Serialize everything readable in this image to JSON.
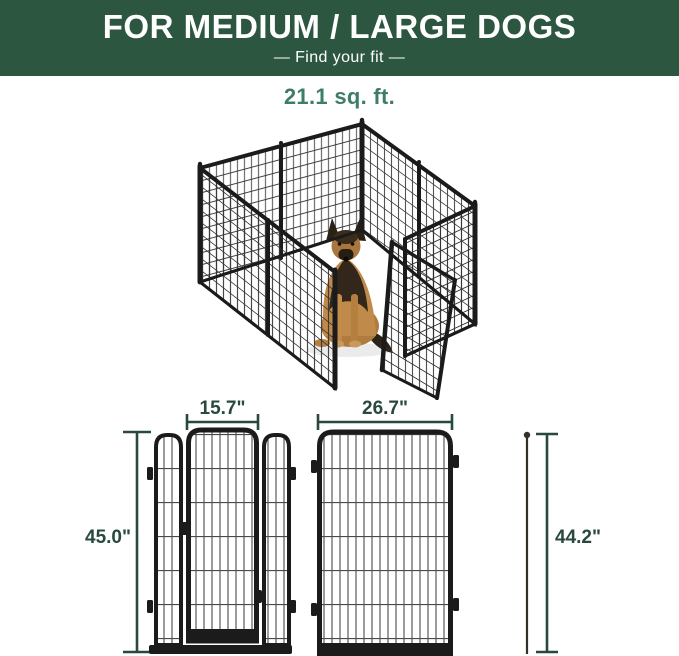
{
  "colors": {
    "banner_bg": "#2C5640",
    "banner_text": "#FFFFFF",
    "accent_green": "#3E7E66",
    "dim_line": "#29493D",
    "frame_black": "#1B1B1B",
    "wire_gray": "#4A4A4A",
    "dog_tan": "#C08A4A",
    "dog_dark": "#32271A"
  },
  "banner": {
    "title": "FOR MEDIUM / LARGE DOGS",
    "subtitle": "—  Find your fit  —"
  },
  "area": {
    "label": "21.1 sq. ft."
  },
  "product": {
    "image_alt": "8-panel metal dog playpen with open door and german shepherd sitting inside"
  },
  "diagrams": {
    "door_panel": {
      "width": "15.7\"",
      "height": "45.0\""
    },
    "wide_panel": {
      "width": "26.7\"",
      "height": "44.2\""
    }
  }
}
